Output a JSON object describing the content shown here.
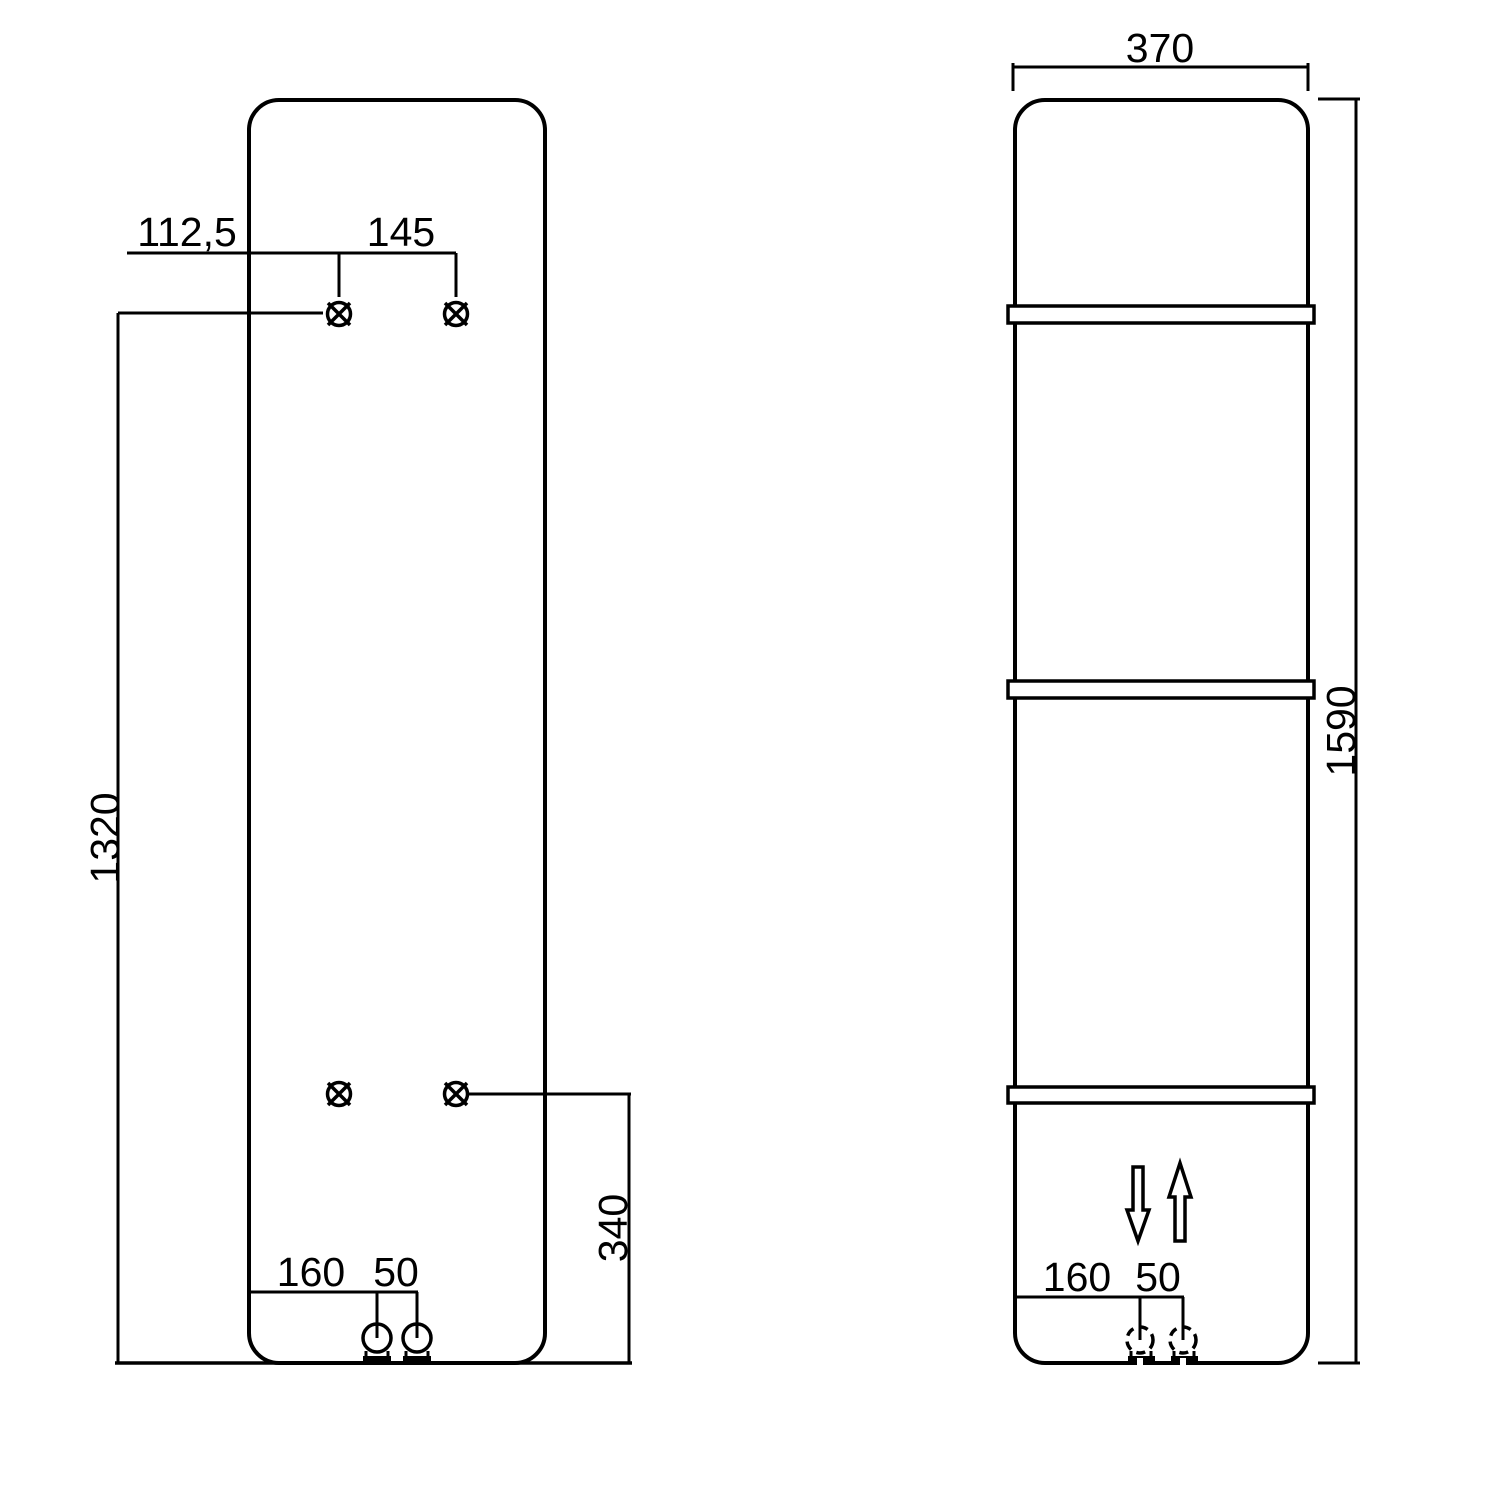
{
  "title": "Radiator panel technical drawing, rear and front views",
  "colors": {
    "background": "#ffffff",
    "line": "#000000",
    "text": "#000000"
  },
  "rear_view": {
    "name": "rear panel view with mounting points and pipe connections",
    "dim_hole_offset": "112,5",
    "dim_hole_spacing": "145",
    "dim_holes_bottom": "1320",
    "dim_lower_holes_bottom": "340",
    "dim_pipe_offset": "160",
    "dim_pipe_spacing": "50",
    "mounting_points": 4,
    "pipe_connections": 2
  },
  "front_view": {
    "name": "front panel view with towel bars and flow arrows",
    "dim_width": "370",
    "dim_height": "1590",
    "dim_pipe_offset": "160",
    "dim_pipe_spacing": "50",
    "towel_bars": 3,
    "flow_arrows": [
      "down",
      "up"
    ]
  }
}
